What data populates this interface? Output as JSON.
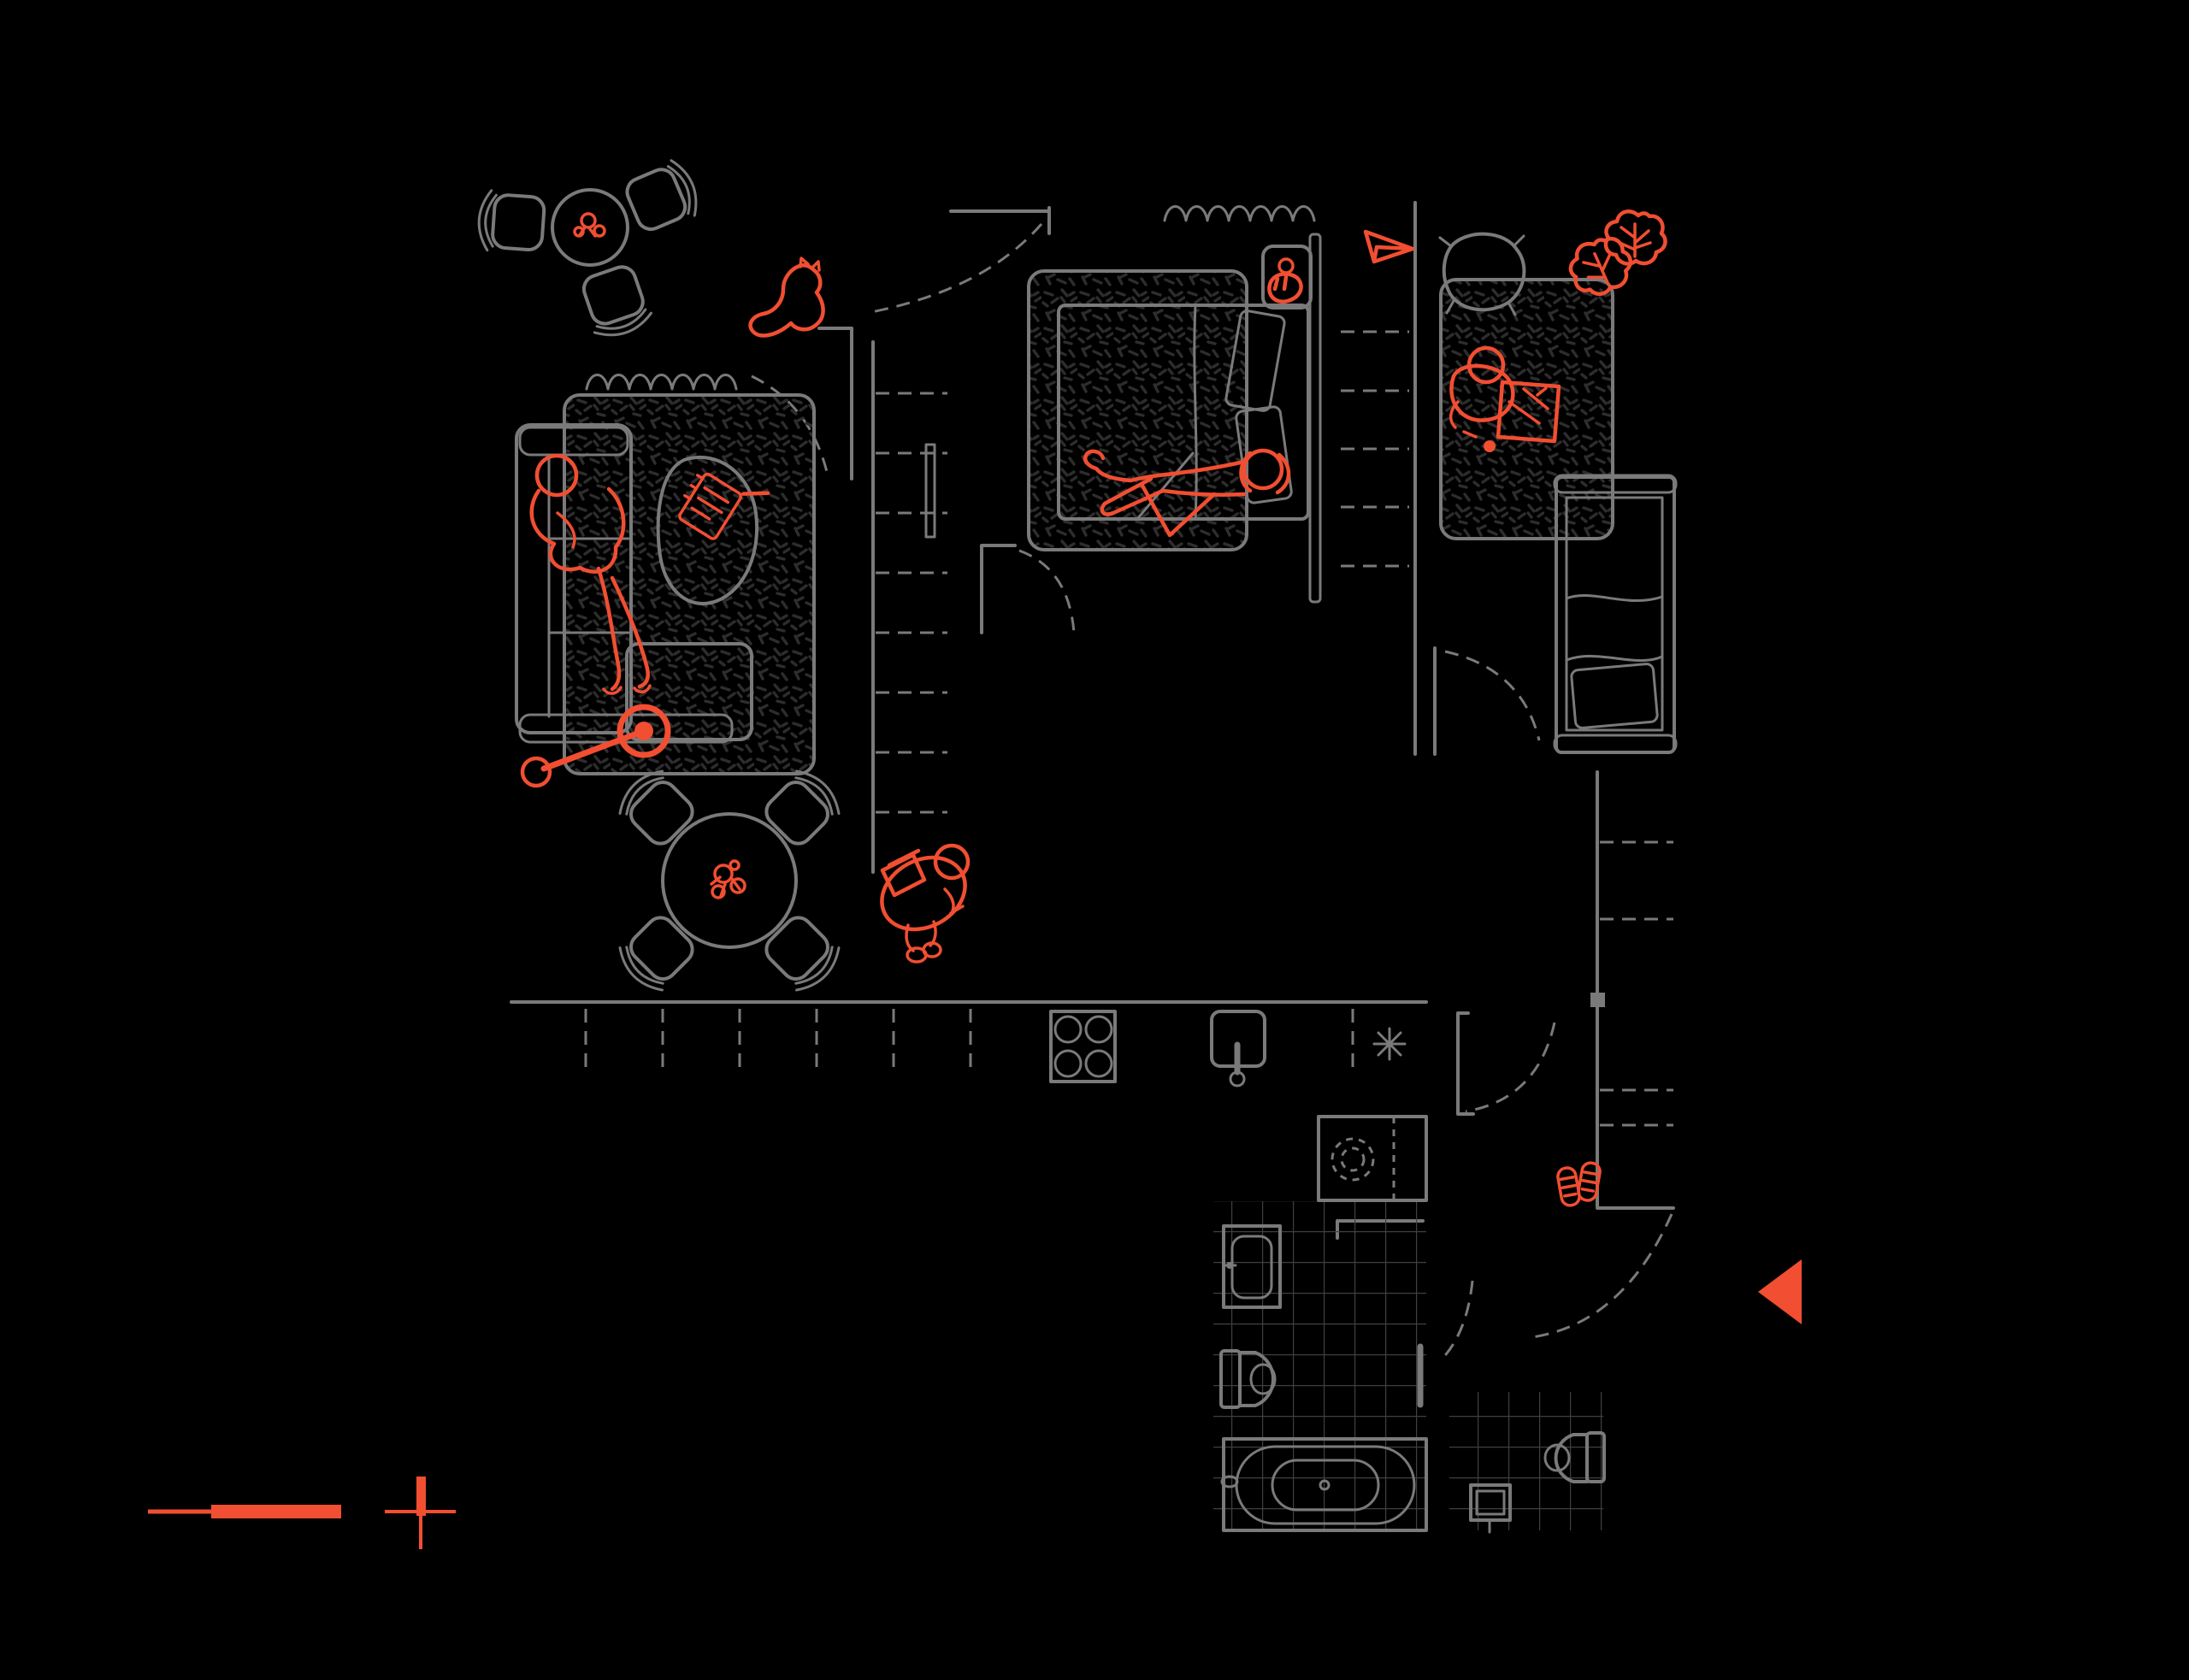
{
  "document": {
    "type": "architectural-floor-plan",
    "style": "dark line drawing, top view, no text labels",
    "visible_text": []
  },
  "palette": {
    "background": "#000000",
    "line": "#7a7a7a",
    "speckle": "#2d2d2d",
    "tile": "#3f3f3f",
    "accent": "#f14e32"
  },
  "markers": {
    "scale_bar": "graphic scale bar (accent)",
    "reference_cross": "surveyor cross mark (accent)",
    "entrance_arrow": "solid left-pointing triangle at the entrance (accent)"
  },
  "rooms": [
    {
      "name": "living-room",
      "furniture": [
        "corner-sofa",
        "textured-rug",
        "organic-coffee-table",
        "window-curtain",
        "cafe-table-3-chairs",
        "round-dining-table-4-chairs"
      ],
      "accent_items": [
        "person-lying-on-sofa",
        "notebook-and-pen-on-table",
        "pull-toy",
        "cat",
        "flowers-on-cafe-table",
        "flowers-on-dining-table",
        "person-walking-with-bags"
      ]
    },
    {
      "name": "bedroom",
      "furniture": [
        "double-bed",
        "two-pillows",
        "headboard",
        "nightstand",
        "rug-under-bed",
        "window-curtain",
        "wardrobe-dashed-shelves",
        "closet-column-with-mirror"
      ],
      "accent_items": [
        "person-lying-on-bed",
        "cup-and-croissant-on-nightstand",
        "paper-plane"
      ]
    },
    {
      "name": "kids-room",
      "furniture": [
        "single-bed-with-blanket-and-pillow",
        "textured-rug",
        "small-armchair",
        "closet-dashed-shelves"
      ],
      "accent_items": [
        "child-playing-on-rug",
        "play-board",
        "monstera-plant"
      ]
    },
    {
      "name": "kitchen",
      "furniture": [
        "counter-run-with-dashed-cabinet-divisions",
        "four-burner-stove",
        "sink-with-tap",
        "light-asterisk-symbol"
      ]
    },
    {
      "name": "bathroom",
      "furniture": [
        "washing-machine-dashed-drum",
        "washbasin",
        "toilet",
        "towel-rail",
        "bathtub",
        "tiled-floor",
        "glass-partition"
      ]
    },
    {
      "name": "wc",
      "furniture": [
        "toilet",
        "corner-basin",
        "tiled-floor"
      ]
    },
    {
      "name": "hallway",
      "furniture": [
        "dashed-door-swings",
        "dashed-storage-shelves"
      ],
      "accent_items": [
        "slippers",
        "entrance-arrow"
      ]
    }
  ]
}
